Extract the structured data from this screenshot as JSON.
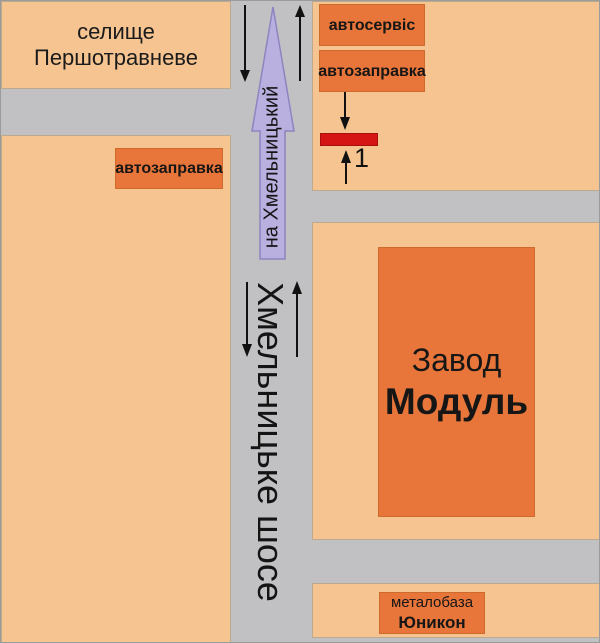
{
  "colors": {
    "road": "#c1c0c2",
    "block": "#f6c491",
    "block_border": "#bca98e",
    "landmark": "#e8763a",
    "marker": "#d51414",
    "direction_fill": "#b9b0e0",
    "direction_border": "#8d84c0",
    "text": "#1b1b1b"
  },
  "map": {
    "village": {
      "line1": "селище",
      "line2": "Першотравневе"
    },
    "top_right": {
      "autoservice_label": "автосервіс",
      "gas_station_label": "автозаправка",
      "marker_number": "1"
    },
    "left": {
      "gas_station_label": "автозаправка"
    },
    "direction_arrow_label": "на Хмельницький",
    "road_name_label": "Хмельницьке шосе",
    "factory": {
      "line1": "Завод",
      "line2": "Модуль"
    },
    "metal_base": {
      "line1": "металобаза",
      "line2": "Юникон"
    }
  }
}
